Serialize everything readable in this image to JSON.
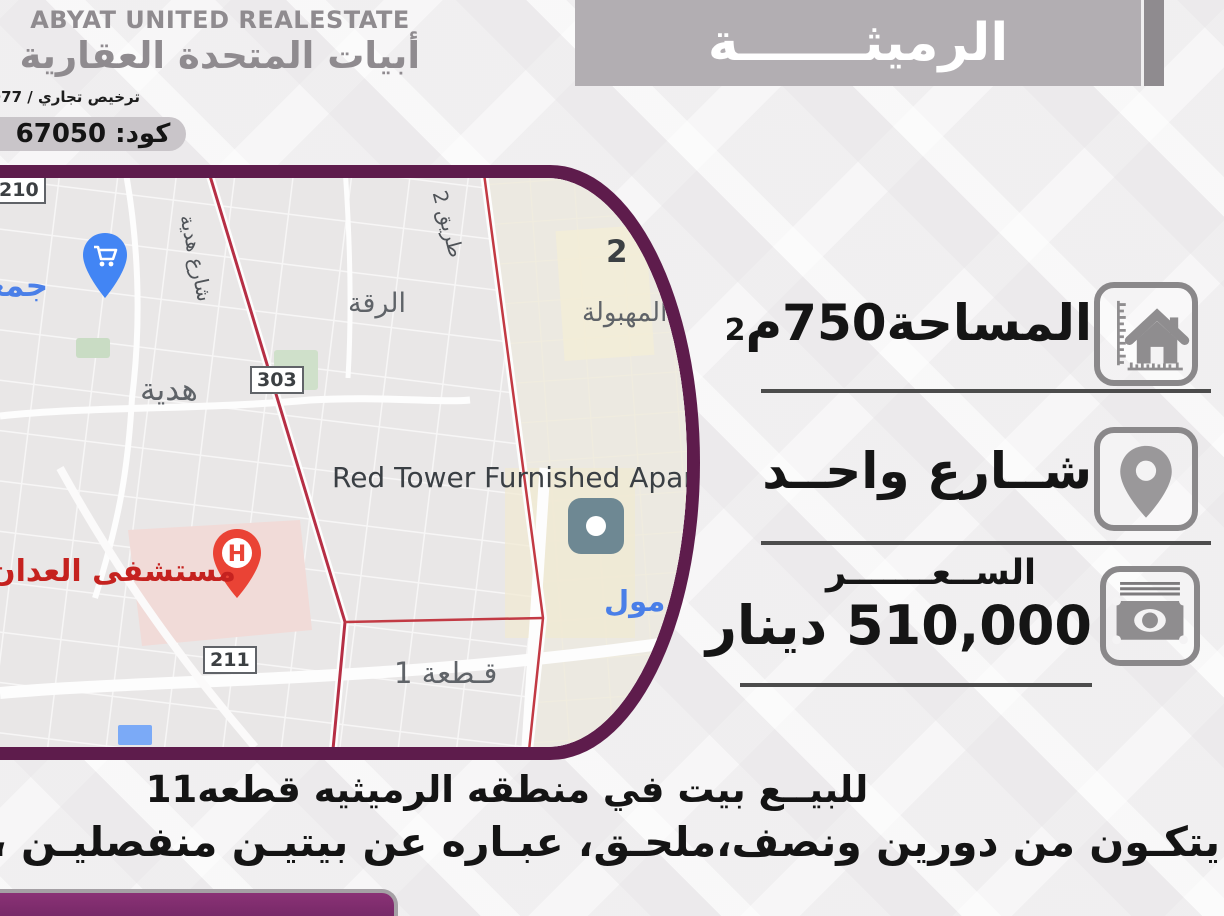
{
  "brand": {
    "name_en": "ABYAT UNITED REALESTATE",
    "name_ar": "أبيات المتحدة العقارية",
    "license": "ترخيص تجاري / 445977",
    "code": "كود: 67050"
  },
  "banner": {
    "title": "الرميثـــــــة"
  },
  "details": {
    "area": {
      "text": "المساحة750م",
      "sup": "2"
    },
    "street": {
      "text": "شــارع واحــد"
    },
    "price": {
      "label": "الســعـــــــر",
      "value": "510,000 دينار"
    }
  },
  "description": {
    "line1": "للبيــع بيت في منطقه الرميثيه قطعه11",
    "line2": "يتكـون من دورين ونصف،ملحـق، عبـاره عن بيتيـن منفصليـن ، سـكن المالك، حوش ."
  },
  "map": {
    "badge_210": "210",
    "badge_303": "303",
    "badge_211": "211",
    "coop": "جمعية",
    "hadiya_street": "شارع هدية",
    "hadiya": "هدية",
    "riqqa": "الرقة",
    "tariq2": "طريق 2",
    "block2": "2",
    "mahboula": "المهبولة",
    "red_tower": "Red Tower Furnished Apartments",
    "mall": "مول",
    "hospital": "مستشفى العدان",
    "hospital_h": "H",
    "block1": "قـطعة 1"
  },
  "colors": {
    "frame_purple": "#5e1c4c",
    "bar_purple": "#7c2a69",
    "banner_gray": "#b2aeb2",
    "boundary_red": "#c23a44",
    "pin_blue": "#4285f4",
    "hospital_red": "#ea4335"
  }
}
